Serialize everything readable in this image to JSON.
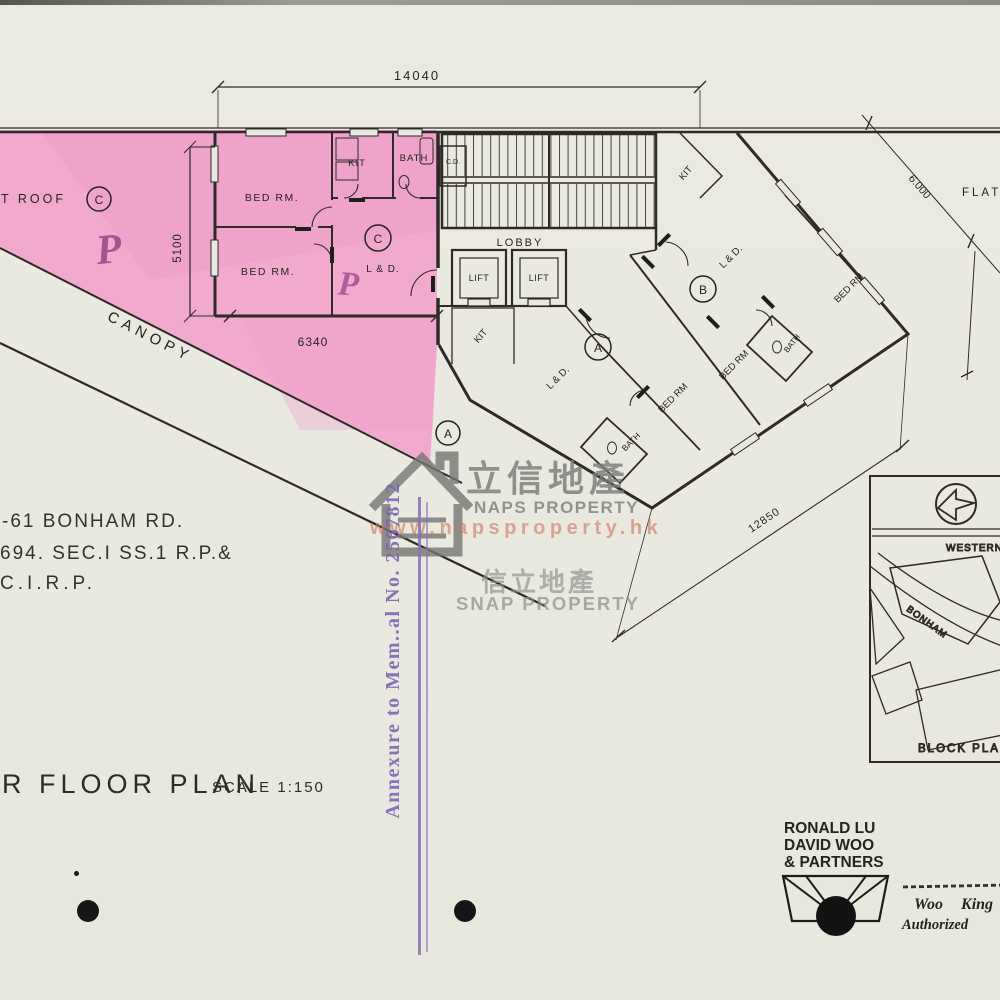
{
  "colors": {
    "paper": "#e9e9e1",
    "highlight_pink": "#f2a9ce",
    "stamp_purple": "#7a67b2",
    "watermark_gray": "#7c7c7a",
    "url_orange": "#cd735a"
  },
  "dims": {
    "top": "14040",
    "left": "5100",
    "flat_c_width": "6340",
    "right": "6.000",
    "wing": "12850"
  },
  "labels": {
    "flat_roof": "FLAT ROOF",
    "canopy": "CANOPY",
    "lobby": "LOBBY",
    "lift": "LIFT",
    "cd": "C.D.",
    "kit": "KIT",
    "bath": "BATH",
    "bed": "BED RM",
    "bed_dot": "BED RM.",
    "ld": "L & D.",
    "unit_a": "A",
    "unit_b": "B",
    "unit_c": "C",
    "hand_p": "P"
  },
  "address": {
    "line1": "-61 BONHAM RD.",
    "line2": "694. SEC.I SS.1 R.P.&",
    "line3": "C.I.R.P."
  },
  "title": {
    "name": "R FLOOR PLAN",
    "scale": "SCALE 1:150"
  },
  "stamp": {
    "text": "Annexure to Mem..al No. 2567812"
  },
  "watermark": {
    "cjk_large": "立信地產",
    "brand_large": "NAPS PROPERTY",
    "url": "www.napsproperty.hk",
    "cjk_small": "信立地產",
    "brand_small": "SNAP PROPERTY"
  },
  "block_plan": {
    "road_top": "WESTERN",
    "road_curved": "BONHAM",
    "caption": "BLOCK PLAN"
  },
  "firm": {
    "line1": "RONALD LU",
    "line2": "DAVID WOO",
    "line3": "& PARTNERS"
  },
  "signature": {
    "name": "Woo King",
    "role": "Authorized"
  }
}
